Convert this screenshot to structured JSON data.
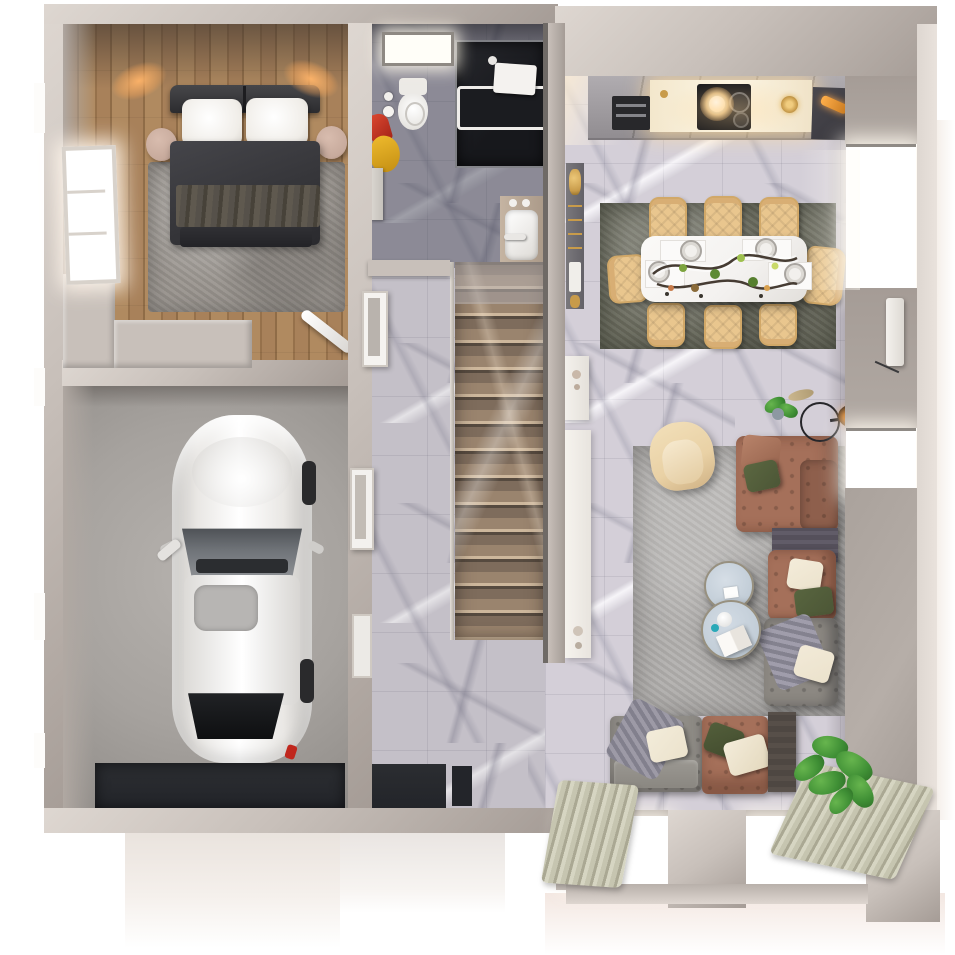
{
  "scene": {
    "type": "3d-rendered-floor-plan-top-down",
    "floor": "ground floor apartment / house",
    "rooms": [
      {
        "name": "bedroom",
        "position": "top-left",
        "floor_material": "wood-planks",
        "furniture": [
          "double-bed",
          "headboard",
          "white-pillows",
          "dark-duvet",
          "throw-blanket",
          "nightstand-left",
          "nightstand-right",
          "wall-sconce-left",
          "wall-sconce-right",
          "gray-area-rug",
          "side-window",
          "ironing-board",
          "closet-platform"
        ]
      },
      {
        "name": "garage",
        "position": "bottom-left",
        "floor_material": "concrete",
        "furniture": [
          "white-car",
          "garage-door-mat",
          "side-door",
          "driveway-outside"
        ]
      },
      {
        "name": "bathroom",
        "position": "top-middle",
        "floor_material": "dark-marble",
        "furniture": [
          "toilet",
          "toilet-paper-holder",
          "towels-red-yellow",
          "shower-enclosure",
          "bathtub",
          "wall-caddy",
          "sink-vanity",
          "skylight-window",
          "wall-mirror"
        ]
      },
      {
        "name": "hallway",
        "position": "middle",
        "floor_material": "gray-marble",
        "furniture": [
          "staircase",
          "stair-rail",
          "front-door",
          "doormats",
          "gold-accent-shelf",
          "white-console"
        ]
      },
      {
        "name": "kitchen",
        "position": "top-right",
        "floor_material": "light-marble",
        "furniture": [
          "counter-run",
          "lit-marble-worktop",
          "cooktop",
          "pendant-light",
          "oven",
          "refrigerator",
          "gold-decor"
        ]
      },
      {
        "name": "dining-area",
        "position": "right",
        "floor_material": "light-marble",
        "furniture": [
          "dining-table",
          "tan-quilted-chairs",
          "placemats",
          "plates",
          "branch-centerpiece",
          "olive-rug"
        ]
      },
      {
        "name": "living-room",
        "position": "bottom-right",
        "floor_material": "light-marble",
        "furniture": [
          "cream-armchair",
          "brown-leather-sectional",
          "gray-sofa",
          "gray-chaise",
          "round-coffee-tables",
          "floor-lamp",
          "potted-plants",
          "media-console",
          "light-gray-rug",
          "curtains",
          "picture-windows",
          "radiator"
        ]
      }
    ],
    "counts": {
      "dining_chairs": 8,
      "stair_steps": 14,
      "right_wall_windows": 2,
      "bottom_wall_windows": 2,
      "cars": 1
    }
  },
  "palette": {
    "wall": "#c8c0ba",
    "wall_light": "#ded7d1",
    "wall_dark": "#a59c96",
    "wall_face": "#b1a9a3",
    "wood": "#a8815a",
    "concrete": "#a6a29e",
    "marble": "#c4c0c8",
    "marble_dark": "#8e8c98",
    "stair_brown": "#7e6c5c",
    "stair_light": "#cdb79c",
    "rug_bedroom": "#99948e",
    "rug_dining": "#6b6c5f",
    "rug_living": "#b2b0ae",
    "bed_duvet": "#36363a",
    "bed_throw": "#56514a",
    "pillow": "#f0ede8",
    "nightstand": "#c7aa9c",
    "car": "#e9e7e4",
    "mat": "#23252a",
    "chair_tan": "#e9c68e",
    "table_white": "#f3f1ef",
    "sofa_brown": "#a5705a",
    "sofa_gray": "#8f8c86",
    "chaise_gray": "#8c8882",
    "console_dark": "#55505b",
    "wood_console": "#4e4742",
    "coffee_blue": "#c2cdd7",
    "armchair": "#e9d1a5",
    "plant": "#3f8f35",
    "plant_dark": "#2e6f27",
    "plant_light": "#67b54e",
    "curtain": "#c6c5b0",
    "glow_warm": "#ffb469",
    "gold": "#c89b4a",
    "shower_dark": "#17181c",
    "olive": "#4c5636",
    "cream": "#ebe2cc"
  }
}
